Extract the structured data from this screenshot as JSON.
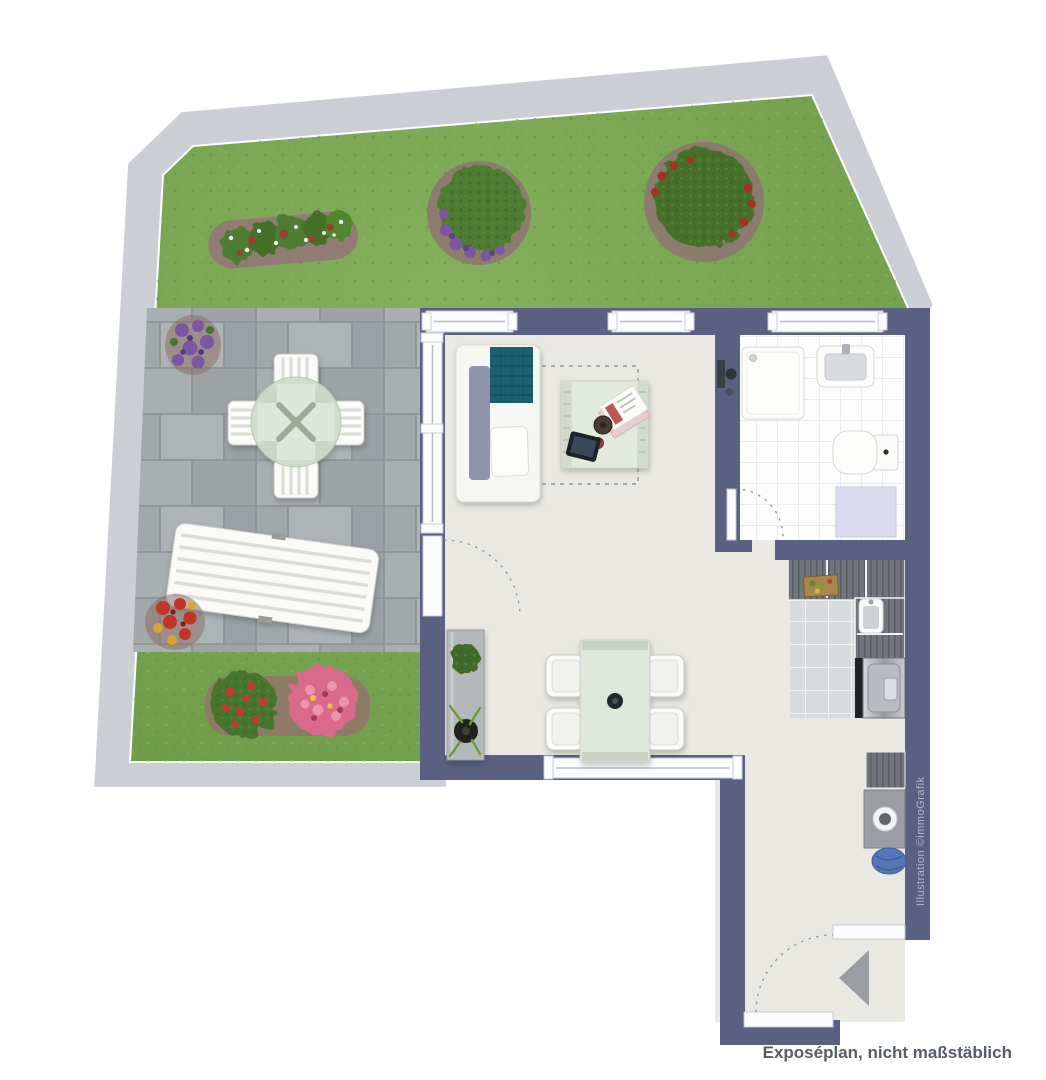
{
  "meta": {
    "type": "floor-plan",
    "width_px": 1046,
    "height_px": 1080
  },
  "footer": {
    "caption": "Exposéplan, nicht maßstäblich"
  },
  "watermark": {
    "credit": "Illustration ©immoGrafik"
  },
  "icons": {
    "entrance_arrow": "triangle-pointing-left"
  },
  "palette": {
    "wall": "#596081",
    "floor": "#EAE8E2",
    "grass": "#76A452",
    "garden_path": "#CBCED4",
    "terrace_pavers": "#A6ABAE",
    "sofa_throw_teal": "#1F6170",
    "sofa_back_gray": "#8E94AD",
    "table_green": "#DFE7DA",
    "bath_mat_lavender": "#DADAF0",
    "laundry_basket_blue": "#5577B8",
    "bush_green": "#4E7C31",
    "flowers_purple": "#7B57A1",
    "flowers_red": "#C13A30",
    "flowers_pink": "#D96A8C"
  }
}
